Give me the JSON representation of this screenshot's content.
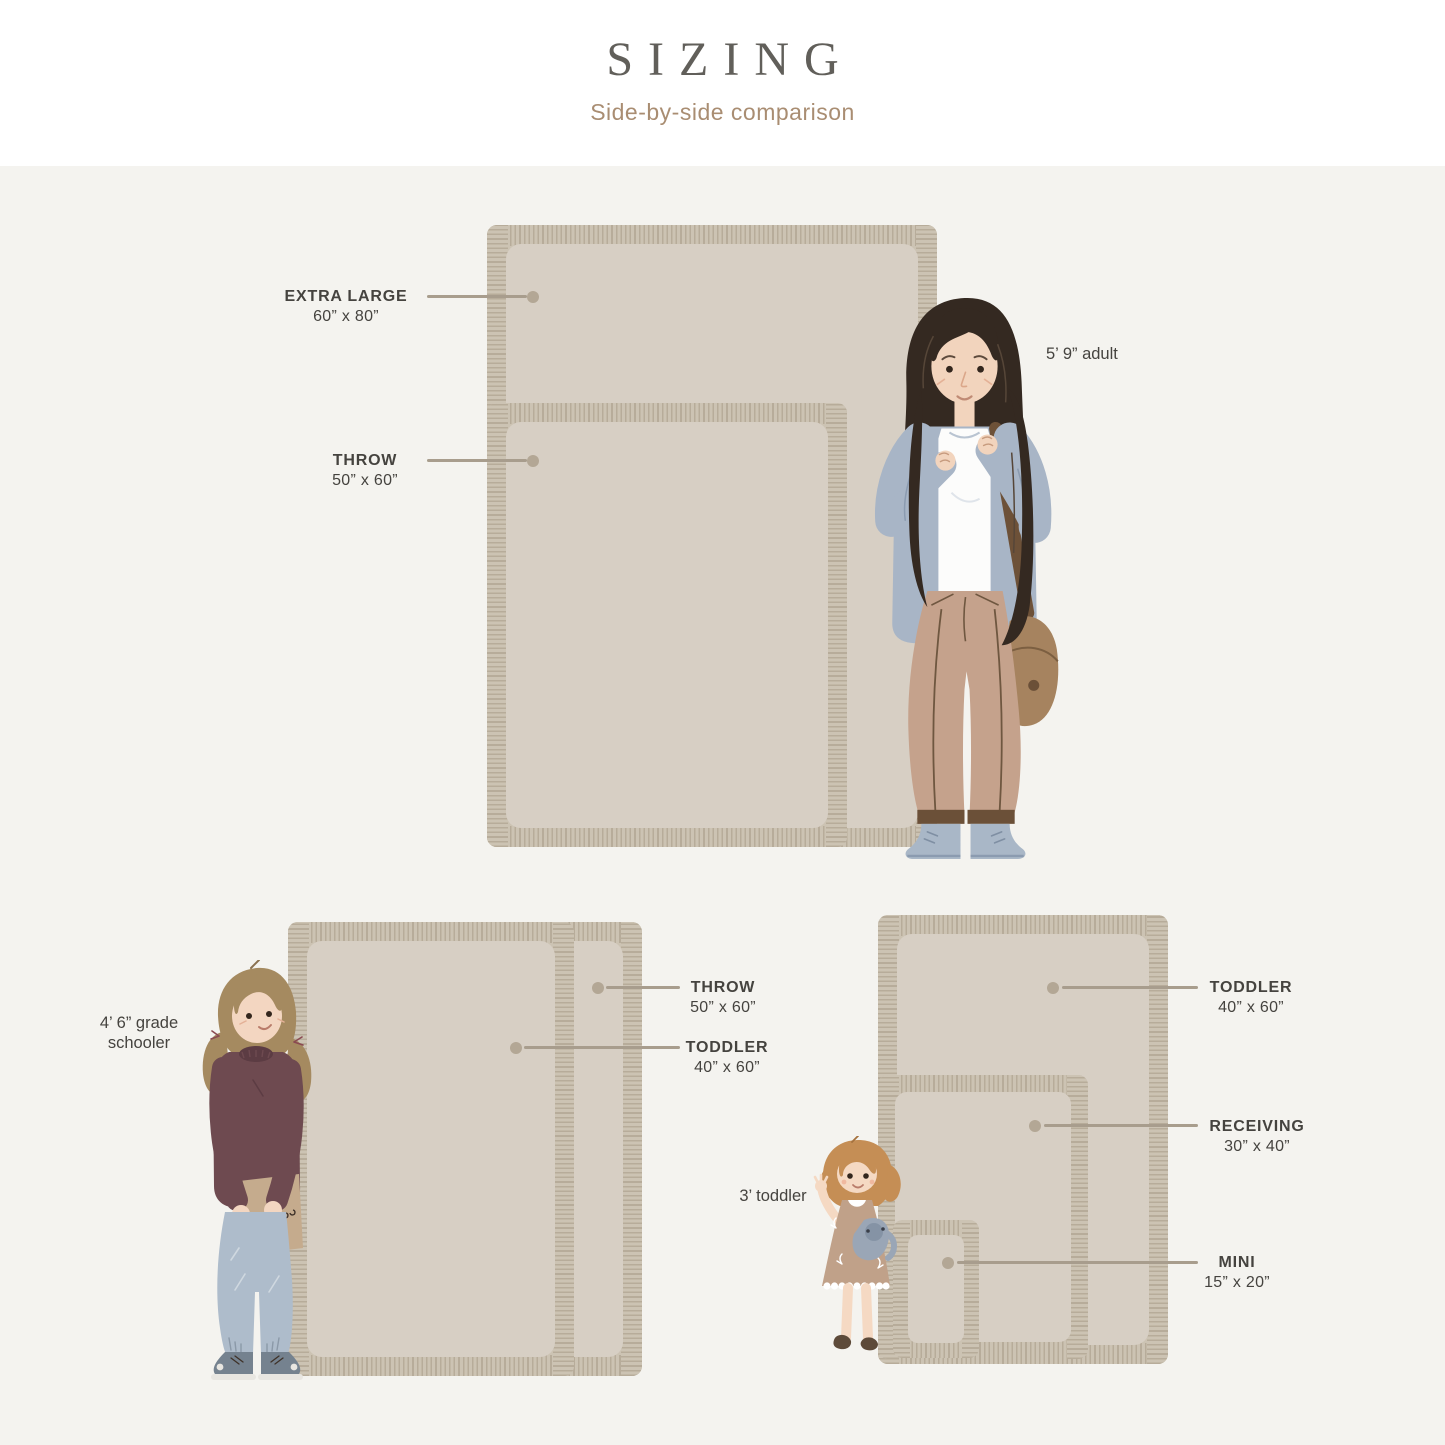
{
  "header": {
    "title": "SIZING",
    "subtitle": "Side-by-side comparison"
  },
  "top_group": {
    "extra_large_label": "EXTRA LARGE",
    "extra_large_dims": "60” x 80”",
    "throw_label": "THROW",
    "throw_dims": "50” x 60”",
    "figure_label": "5’ 9” adult"
  },
  "bottom_left_group": {
    "throw_label": "THROW",
    "throw_dims": "50” x 60”",
    "toddler_label": "TODDLER",
    "toddler_dims": "40” x 60”",
    "figure_label_line1": "4’ 6” grade",
    "figure_label_line2": "schooler"
  },
  "bottom_right_group": {
    "toddler_label": "TODDLER",
    "toddler_dims": "40” x 60”",
    "receiving_label": "RECEIVING",
    "receiving_dims": "30” x 40”",
    "mini_label": "MINI",
    "mini_dims": "15” x 20”",
    "figure_label": "3’ toddler"
  },
  "colors": {
    "header_background": "#ffffff",
    "page_background": "#f4f3ef",
    "title_text": "#615f5a",
    "subtitle_text": "#a98d72",
    "label_text": "#45433f",
    "leader_line": "#a89d8d",
    "leader_dot": "#b3a795",
    "blanket_fringe": "#ccc3b3",
    "blanket_fringe_stripe": "#b7ac9a",
    "blanket_inner": "#d7cfc4"
  }
}
